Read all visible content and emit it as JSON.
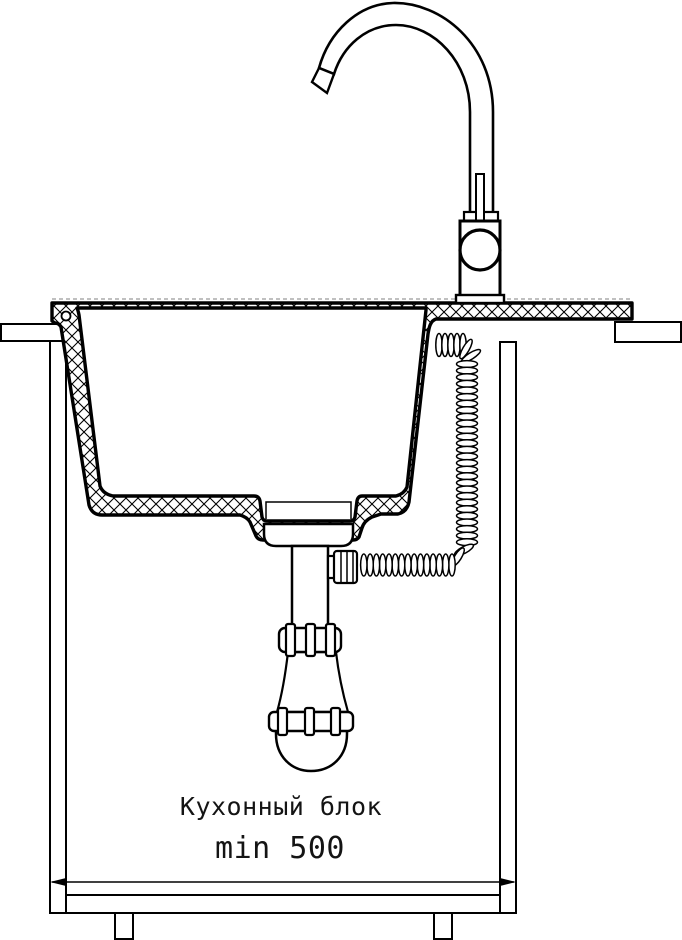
{
  "diagram": {
    "kind": "sink-installation-cross-section",
    "labels": {
      "cabinet": "Кухонный блок",
      "min_width": "min 500"
    },
    "dimension": {
      "qualifier": "min",
      "value": "500"
    },
    "colors": {
      "line": "#000000",
      "background": "#ffffff",
      "guide_dash": "#9a9a9a"
    }
  }
}
